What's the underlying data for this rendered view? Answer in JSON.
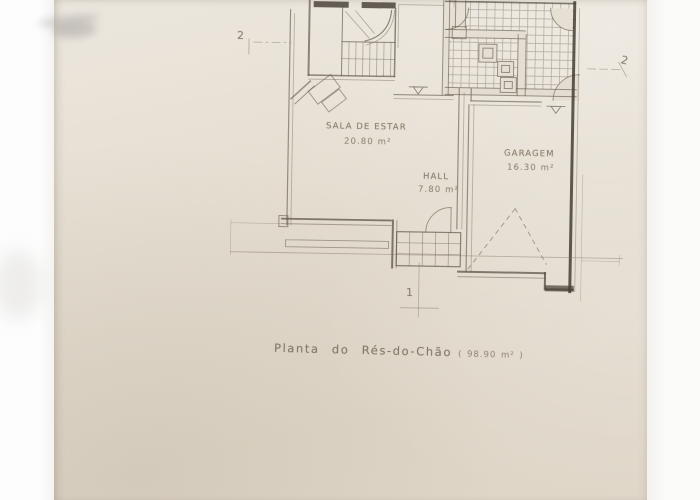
{
  "plan": {
    "title_main": "Planta  do  Rés-do-Chão",
    "title_area": "( 98.90 m² )",
    "rooms": [
      {
        "name": "SALA DE ESTAR",
        "area": "20.80 m²"
      },
      {
        "name": "GARAGEM",
        "area": "16.30 m²"
      },
      {
        "name": "HALL",
        "area": "7.80 m²"
      }
    ],
    "markers": {
      "section_left": "2",
      "section_right": "2",
      "section_bottom": "1"
    },
    "colors": {
      "paper": "#e3dccf",
      "scanner_background": "#fbfbfb",
      "pencil": "#7a7060",
      "pencil_dark": "#4a443b"
    }
  }
}
